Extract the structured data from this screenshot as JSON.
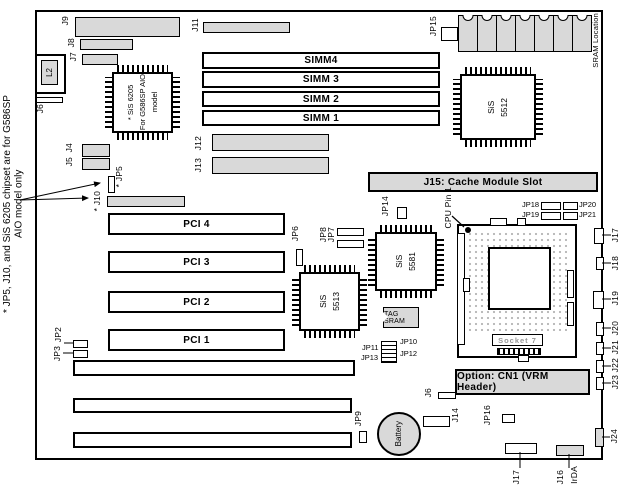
{
  "note": {
    "line1": "* JP5, J10, and SiS 6205 chipset are for G586SP",
    "line2": "AIO model only"
  },
  "colors": {
    "board_fill": "#ffffff",
    "part_gray": "#d9d9d9",
    "line": "#000000"
  },
  "chips": {
    "sis6205": {
      "line1": "* SiS 6205",
      "line2": "For G586SP AIO",
      "line3": "model"
    },
    "sis5512": {
      "line1": "SiS",
      "line2": "5512"
    },
    "sis5513": {
      "line1": "SiS",
      "line2": "5513"
    },
    "sis5581": {
      "line1": "SiS",
      "line2": "5581"
    },
    "tag_sram": {
      "label": "TAG SRAM"
    },
    "battery": {
      "label": "Battery"
    },
    "sram_row": {
      "label": "SRAM Location",
      "chip_count": 7
    }
  },
  "slots": {
    "simm": [
      "SIMM4",
      "SIMM 3",
      "SIMM 2",
      "SIMM 1"
    ],
    "pci": [
      "PCI 4",
      "PCI 3",
      "PCI 2",
      "PCI 1"
    ],
    "cache_label": "J15: Cache Module Slot",
    "socket_label": "Socket 7",
    "vrm_label": "Option: CN1 (VRM Header)"
  },
  "jumpers": {
    "j9": "J9",
    "j8": "J8",
    "j7": "J7",
    "l2": "L2",
    "j6_top": "J6",
    "j11": "J11",
    "j12": "J12",
    "j13": "J13",
    "j4": "J4",
    "j5": "J5",
    "jp5": "* JP5",
    "j10": "* J10",
    "jp2": "JP2",
    "jp3": "JP3",
    "jp6": "JP6",
    "jp8": "JP8",
    "jp7": "JP7",
    "jp14": "JP14",
    "jp15": "JP15",
    "cpu_pin": "CPU Pin 1",
    "jp18": "JP18",
    "jp19": "JP19",
    "jp20": "JP20",
    "jp21": "JP21",
    "jp11": "JP11",
    "jp13": "JP13",
    "jp10": "JP10",
    "jp12": "JP12",
    "jp9": "JP9",
    "j6_mid": "J6",
    "j14": "J14",
    "jp16": "JP16",
    "j17_right": "J17",
    "j18": "J18",
    "j19": "J19",
    "j20": "J20",
    "j21": "J21",
    "j22": "J22",
    "j23": "J23",
    "j24": "J24",
    "j17_bottom": "J17",
    "j16": "J16",
    "irda": "IrDA"
  }
}
